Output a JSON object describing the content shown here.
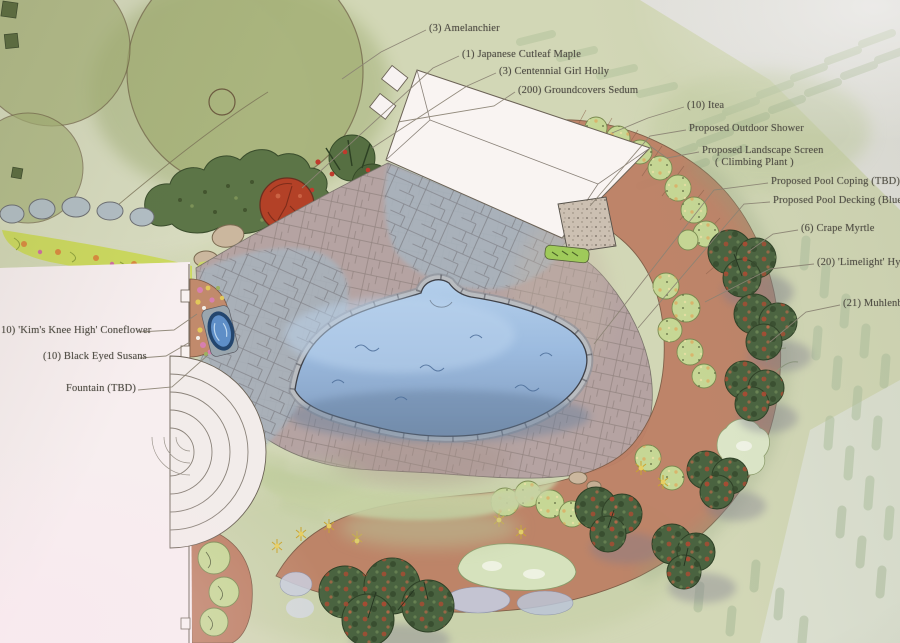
{
  "plan_labels": [
    {
      "id": "amelanchier",
      "text": "(3) Amelanchier"
    },
    {
      "id": "japanese-cutleaf-maple",
      "text": "(1) Japanese Cutleaf Maple"
    },
    {
      "id": "centennial-girl-holly",
      "text": "(3) Centennial Girl Holly"
    },
    {
      "id": "groundcovers-sedum",
      "text": "(200) Groundcovers Sedum"
    },
    {
      "id": "itea",
      "text": "(10) Itea"
    },
    {
      "id": "outdoor-shower",
      "text": "Proposed Outdoor Shower"
    },
    {
      "id": "landscape-screen",
      "text": "Proposed Landscape Screen",
      "text2": "( Climbing Plant )"
    },
    {
      "id": "pool-coping",
      "text": "Proposed Pool Coping (TBD)"
    },
    {
      "id": "pool-decking",
      "text": "Proposed Pool Decking (Bluesto"
    },
    {
      "id": "crape-myrtle",
      "text": "(6) Crape Myrtle"
    },
    {
      "id": "limelight-hydrangea",
      "text": "(20) 'Limelight' Hyd"
    },
    {
      "id": "muhlenbergia",
      "text": "(21) Muhlenb"
    },
    {
      "id": "kims-knee-high-coneflower",
      "text": "10) 'Kim's Knee High' Coneflower"
    },
    {
      "id": "black-eyed-susans",
      "text": "(10) Black Eyed Susans"
    },
    {
      "id": "fountain",
      "text": "Fountain (TBD)"
    }
  ],
  "palette": {
    "paper": "#e6e2d4",
    "paper_pink": "#f5e9ec",
    "lawn": "#cdd4b0",
    "lawn_hatch": "#a9bd9b",
    "tree_canopy": "#a4b075",
    "shrub_dark": "#55703f",
    "maple_red": "#b34127",
    "bed_terracotta": "#bd8065",
    "flagstone": "#a8b3bd",
    "paver": "#b5a3a2",
    "pool_water": "#9cbbdf",
    "pool_coping": "#b9bcc0",
    "fountain_blue": "#5e8ec7",
    "leader_line": "#8b8374",
    "label_text": "#4f4c44"
  }
}
